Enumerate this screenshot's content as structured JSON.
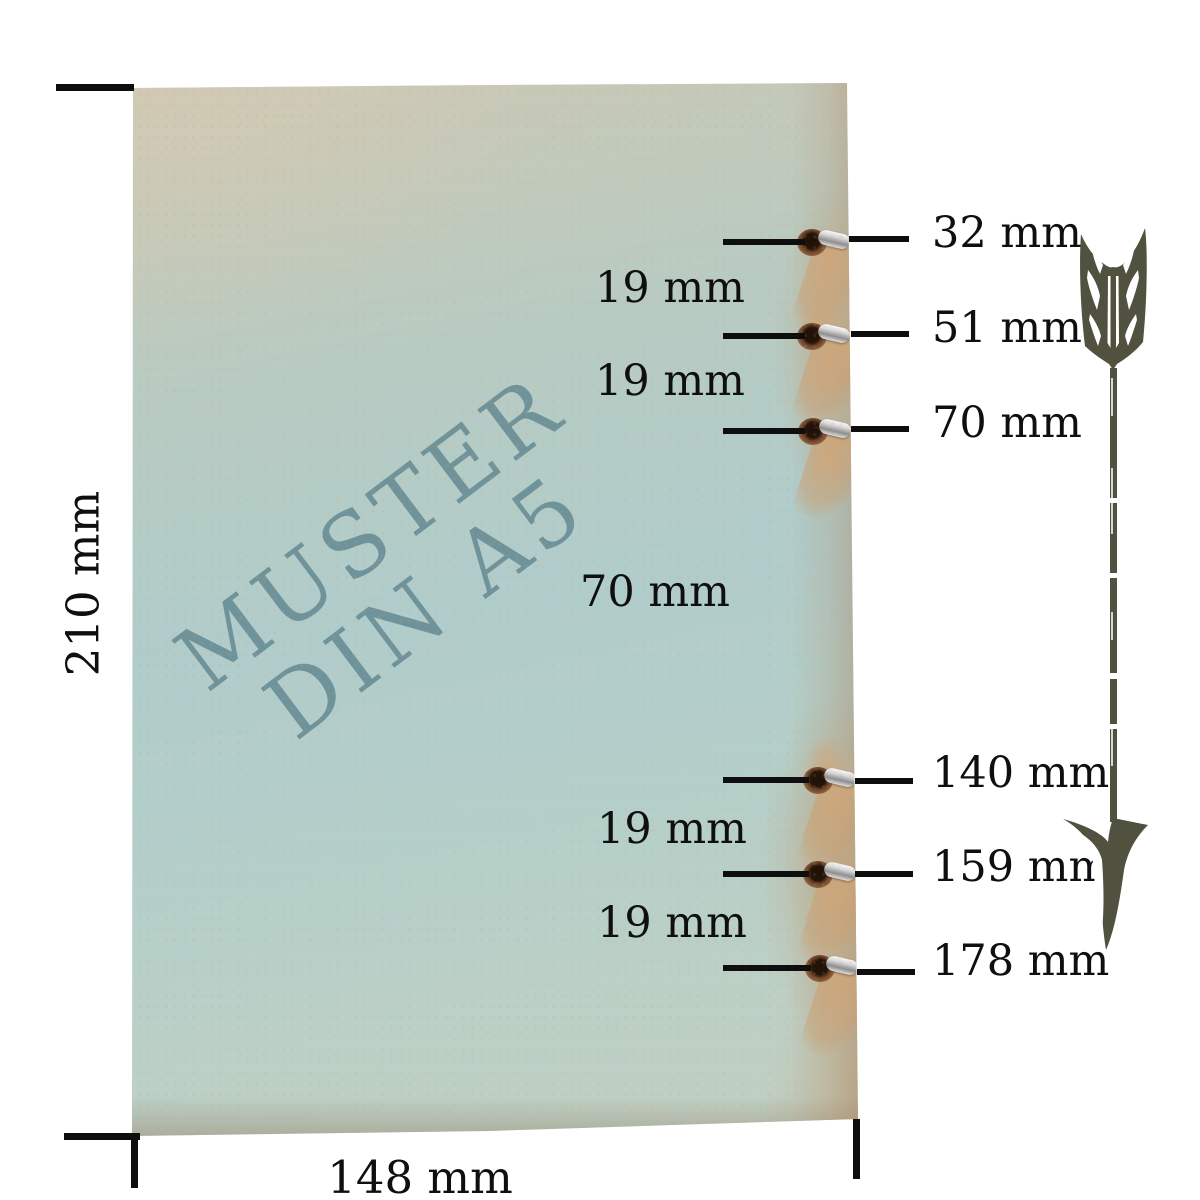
{
  "paper": {
    "watermark_line1": "MUSTER",
    "watermark_line2": "DIN A5",
    "watermark_color": "#608692"
  },
  "dimensions": {
    "height_label": "210 mm",
    "width_label": "148 mm"
  },
  "holes": [
    {
      "label": "32 mm"
    },
    {
      "label": "51 mm"
    },
    {
      "label": "70 mm"
    },
    {
      "label": "140 mm"
    },
    {
      "label": "159 mm"
    },
    {
      "label": "178 mm"
    }
  ],
  "spacings": [
    {
      "label": "19 mm"
    },
    {
      "label": "19 mm"
    },
    {
      "label": "70 mm"
    },
    {
      "label": "19 mm"
    },
    {
      "label": "19 mm"
    }
  ],
  "arrow": {
    "icon": "down-arrow-icon",
    "color": "#50513f"
  },
  "colors": {
    "paper_blue": "#b0cccb",
    "paper_beige": "#cfc8b4",
    "paper_tan": "#c4a37e",
    "line_black": "#0e0e0e",
    "background": "#ffffff"
  }
}
